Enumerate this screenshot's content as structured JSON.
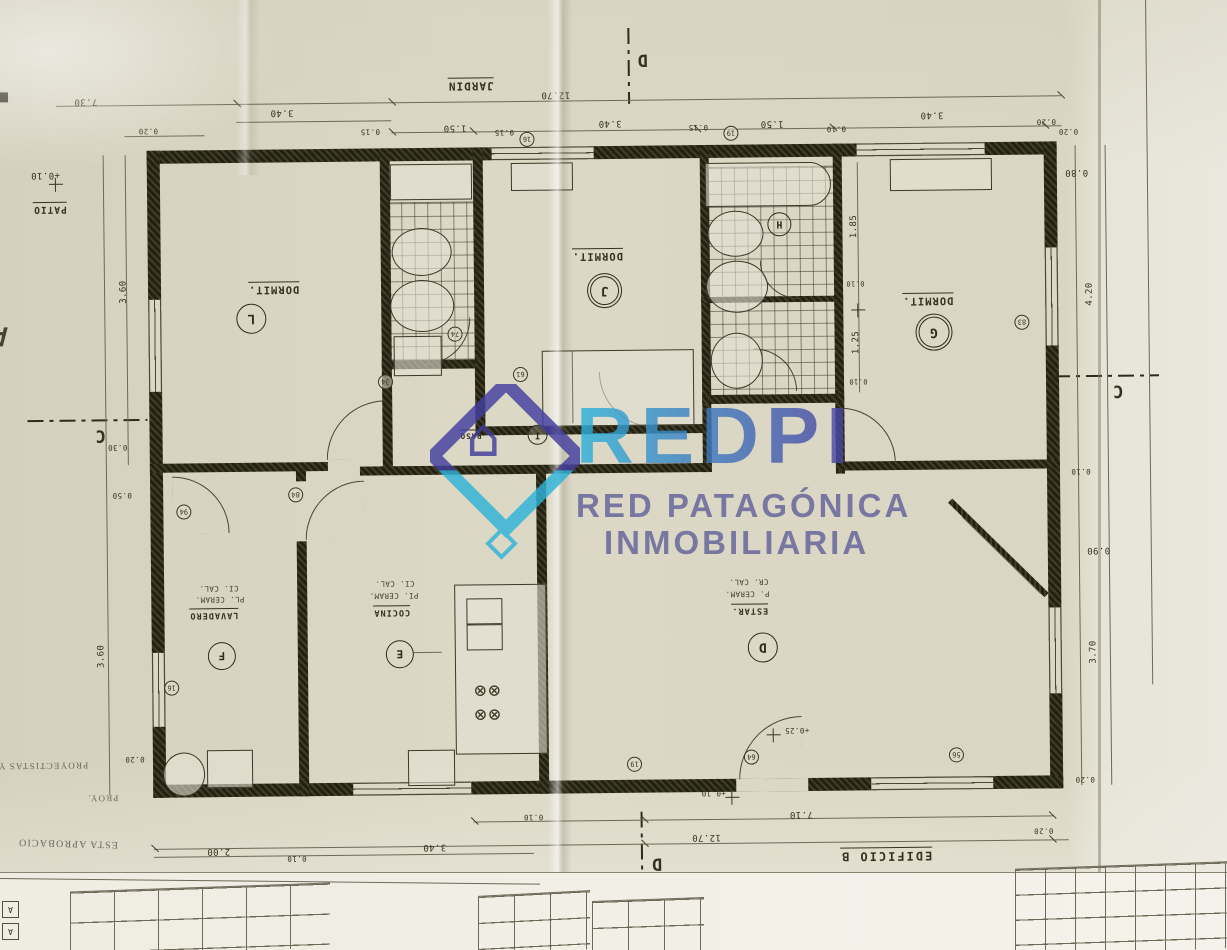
{
  "watermark": {
    "brand": "REDPI",
    "line1": "RED PATAGÓNICA",
    "line2": "INMOBILIARIA",
    "cyan": "#2fb3d9",
    "indigo": "#4b41a1"
  },
  "labels": {
    "jardin": "JARDIN",
    "patio": "PATIO",
    "patio_level": "+0.10",
    "paso": "PASO",
    "edificio": "EDIFICIO B",
    "plantas": "PLANTAS BAJA",
    "estar_door_level": "+0.25",
    "floor_level": "+0.10",
    "section_d": "D",
    "section_c": "C"
  },
  "rooms": {
    "dorm_l": {
      "name": "DORMIT.",
      "key": "L"
    },
    "dorm_j": {
      "name": "DORMIT.",
      "key": "J"
    },
    "dorm_g": {
      "name": "DORMIT.",
      "key": "G"
    },
    "lavadero": {
      "name": "LAVADERO",
      "finish_floor": "PL. CERAM.",
      "finish_ceil": "CI. CAL.",
      "key": "F"
    },
    "cocina": {
      "name": "COCINA",
      "finish_floor": "PI. CERAM.",
      "finish_ceil": "CI. CAL.",
      "key": "E"
    },
    "estar": {
      "name": "ESTAR.",
      "finish_floor": "P. CERAM.",
      "finish_ceil": "CR. CAL.",
      "key": "D"
    },
    "paso_key": "I",
    "bath_key": "H"
  },
  "dims": {
    "top_total": "12.70",
    "top_row": [
      "1.50",
      "0.15",
      "3.40",
      "0.15",
      "1.50",
      "0.10",
      "3.40",
      "0.20"
    ],
    "top_left": [
      "7.30",
      "0.20",
      "3.40",
      "0.15"
    ],
    "left": [
      "+0.10",
      "3.60",
      "0.30",
      "0.50",
      "3.60",
      "0.20"
    ],
    "right": [
      "0.20",
      "0.80",
      "4.20",
      "0.10",
      "0.90",
      "3.70",
      "0.20"
    ],
    "bottom": [
      "2.00",
      "0.10",
      "3.40",
      "0.10",
      "7.10",
      "12.70",
      "0.20"
    ],
    "bath": [
      "1.85",
      "0.10",
      "1.25",
      "0.10"
    ]
  },
  "refs": [
    "16",
    "19",
    "74",
    "61",
    "34",
    "84",
    "94",
    "16",
    "64",
    "56",
    "83",
    "19"
  ],
  "stamps": [
    "PROYECTISTAS Y CAL",
    "PROY.",
    "ESTA APROBACIO"
  ],
  "margin_letters": {
    "side": "A",
    "box1": "A",
    "box2": "A"
  }
}
